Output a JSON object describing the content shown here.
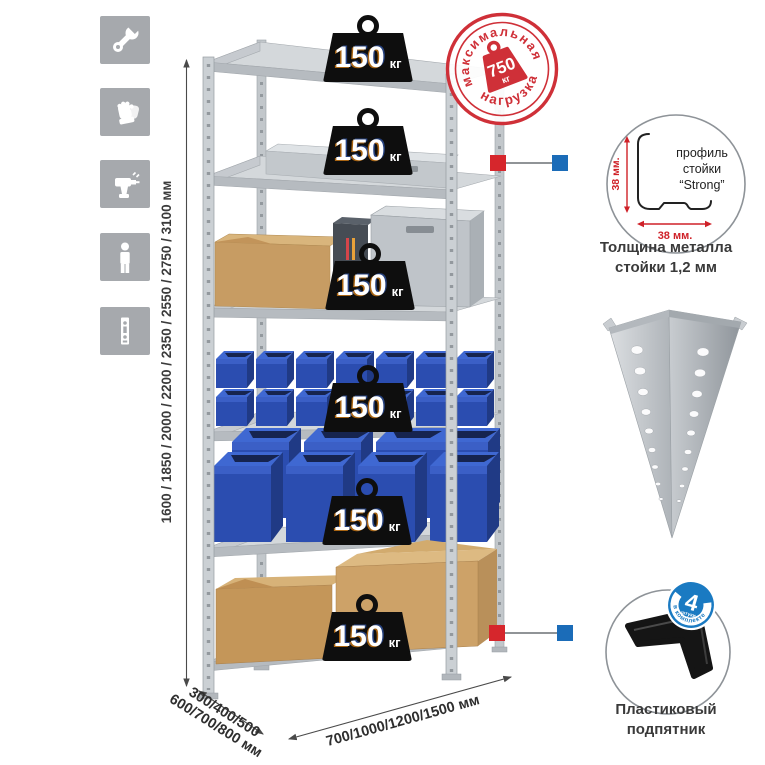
{
  "stamp": {
    "arc_top": "максимальная",
    "arc_bottom": "нагрузка",
    "value": "750",
    "unit": "кг"
  },
  "shelf_loads": [
    {
      "value": "150",
      "unit": "кг"
    },
    {
      "value": "150",
      "unit": "кг"
    },
    {
      "value": "150",
      "unit": "кг"
    },
    {
      "value": "150",
      "unit": "кг"
    },
    {
      "value": "150",
      "unit": "кг"
    },
    {
      "value": "150",
      "unit": "кг"
    }
  ],
  "dimensions": {
    "height": "1600 / 1850 / 2000 / 2200 / 2350 / 2550 / 2750 / 3100 мм",
    "depth_line1": "300/400/500",
    "depth_line2": "600/700/800 мм",
    "width": "700/1000/1200/1500 мм"
  },
  "profile_detail": {
    "label_line1": "профиль",
    "label_line2": "стойки",
    "label_line3": "“Strong”",
    "dim_vertical": "38 мм.",
    "dim_horizontal": "38 мм.",
    "caption_line1": "Толщина металла",
    "caption_line2": "стойки 1,2 мм"
  },
  "foot_detail": {
    "badge_value": "4",
    "badge_small": "штуки",
    "badge_arc": "в комплекте",
    "caption_line1": "Пластиковый",
    "caption_line2": "подпятник"
  },
  "sidebar_icons": [
    {
      "name": "wrench-icon"
    },
    {
      "name": "gloves-icon"
    },
    {
      "name": "drill-icon"
    },
    {
      "name": "person-icon"
    },
    {
      "name": "post-profile-icon"
    }
  ],
  "colors": {
    "accent_red": "#cf3038",
    "accent_blue": "#1b6cb8",
    "icon_bg": "#a6a9ad",
    "bin_blue": "#2b4db0",
    "metal_gray": "#c9cdd1",
    "weight_black": "#0e0e0e"
  }
}
